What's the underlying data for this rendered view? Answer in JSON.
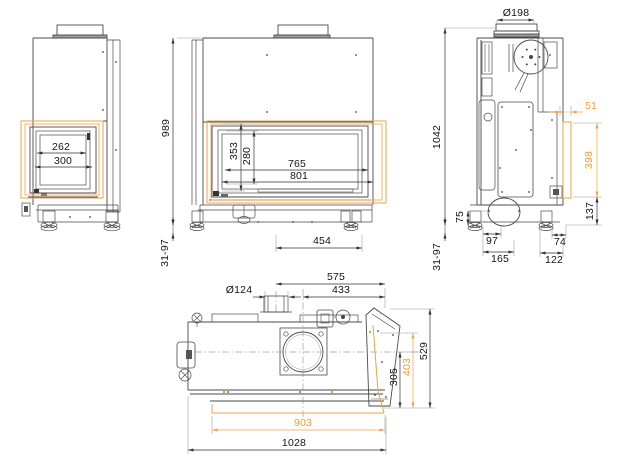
{
  "drawing": {
    "type": "technical-drawing",
    "subject": "corner fireplace insert dimensioned views",
    "views": {
      "left": {
        "glass_inner_width": "262",
        "glass_width": "300"
      },
      "front": {
        "overall_height": "989",
        "glass_height": "353",
        "glass_inner_height": "280",
        "glass_inner_width": "765",
        "glass_width": "801",
        "base_width": "454",
        "foot_range": "31-97"
      },
      "right": {
        "flue_diameter": "Ø198",
        "overall_height": "1042",
        "glass_offset": "51",
        "glass_strip_height": "398",
        "plinth_height": "137",
        "floor_clearance": "75",
        "duct_offset": "97",
        "duct_depth": "165",
        "rear_offset": "74",
        "rear_depth": "122",
        "foot_range": "31-97"
      },
      "top": {
        "flue_pipe_offset": "575",
        "outlet_offset": "433",
        "pipe_diameter": "Ø124",
        "depth_to_axis": "305",
        "glass_depth": "403",
        "overall_depth": "529",
        "glass_width": "903",
        "overall_width": "1028"
      }
    },
    "colors": {
      "line": "#4a4a4a",
      "dim_text": "#141414",
      "accent": "#efa143"
    }
  }
}
